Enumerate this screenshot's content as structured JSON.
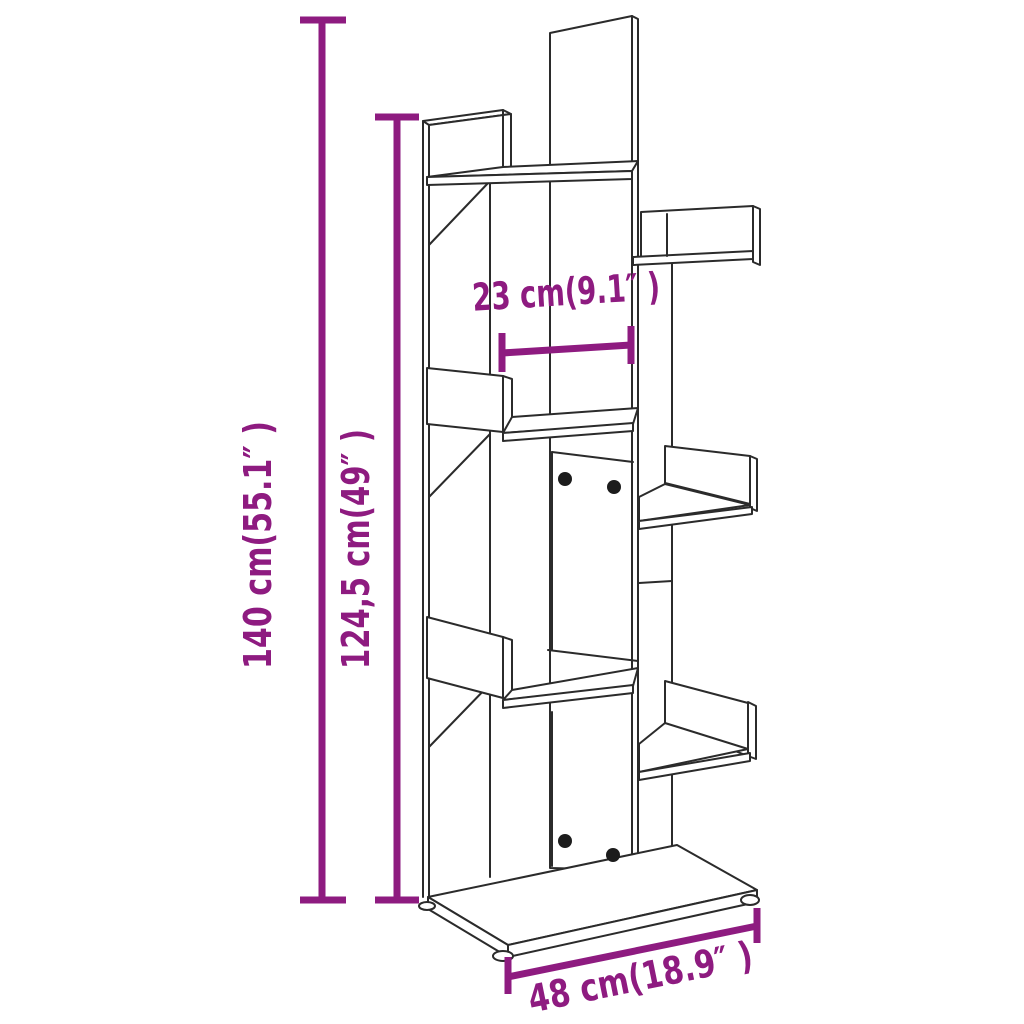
{
  "diagram": {
    "product": "tree-shaped-bookshelf",
    "background_color": "#ffffff",
    "outline_color": "#2b2b2b",
    "accent_color": "#8E1B80",
    "dimensions": [
      {
        "id": "total-height",
        "label": "140 cm(55.1″ )"
      },
      {
        "id": "shelf-height",
        "label": "124,5 cm(49″ )"
      },
      {
        "id": "inner-width",
        "label": "23 cm(9.1″ )"
      },
      {
        "id": "base-width",
        "label": "48 cm(18.9″ )"
      }
    ]
  }
}
